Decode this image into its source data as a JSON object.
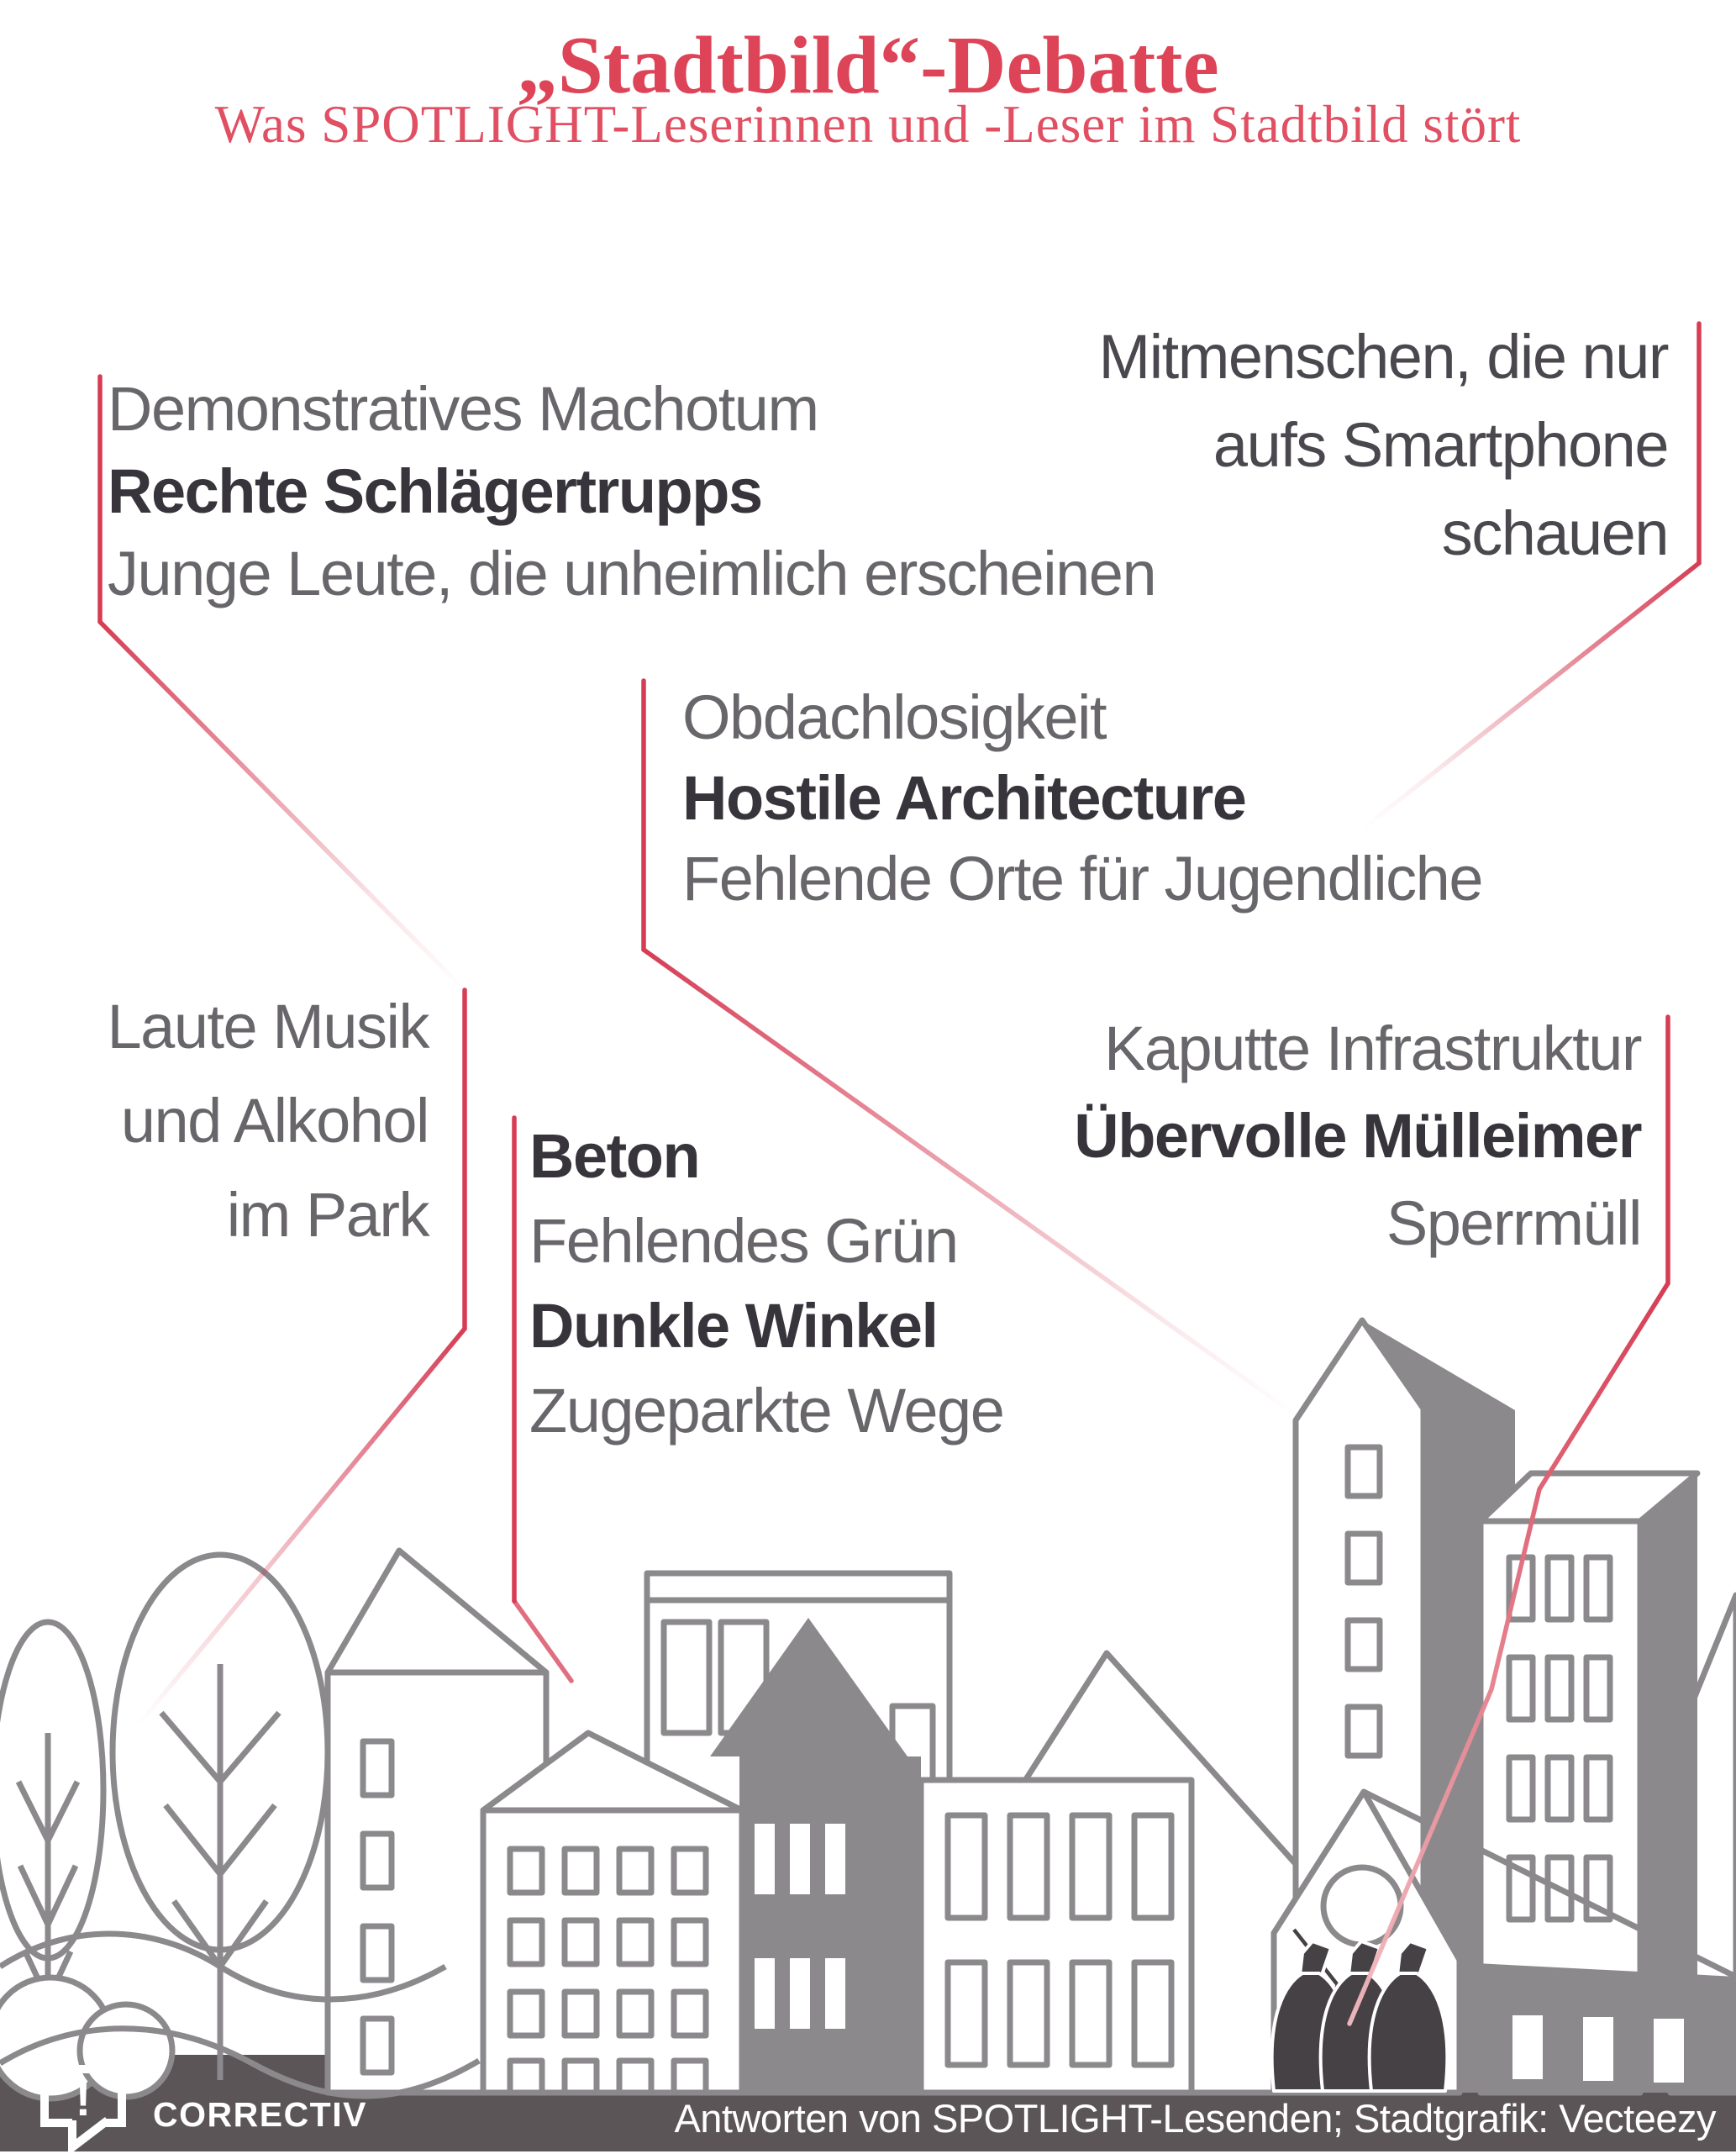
{
  "header": {
    "title": "„Stadtbild“-Debatte",
    "subtitle": "Was SPOTLIGHT-Leserinnen und -Leser im Stadtbild stört"
  },
  "clusters": [
    {
      "id": "machotum",
      "lines": [
        {
          "text": "Demonstratives Machotum",
          "emphasis": "muted"
        },
        {
          "text": "Rechte Schlägertrupps",
          "emphasis": "strong"
        },
        {
          "text": "Junge Leute, die unheimlich erscheinen",
          "emphasis": "muted"
        }
      ]
    },
    {
      "id": "smartphone",
      "lines": [
        {
          "text": "Mitmenschen, die nur",
          "emphasis": "plain"
        },
        {
          "text": "aufs Smartphone",
          "emphasis": "plain"
        },
        {
          "text": "schauen",
          "emphasis": "plain"
        }
      ]
    },
    {
      "id": "obdachlosigkeit",
      "lines": [
        {
          "text": "Obdachlosigkeit",
          "emphasis": "muted"
        },
        {
          "text": "Hostile Architecture",
          "emphasis": "strong"
        },
        {
          "text": "Fehlende Orte für Jugendliche",
          "emphasis": "muted"
        }
      ]
    },
    {
      "id": "park",
      "lines": [
        {
          "text": "Laute Musik",
          "emphasis": "muted"
        },
        {
          "text": "und Alkohol",
          "emphasis": "muted"
        },
        {
          "text": "im Park",
          "emphasis": "muted"
        }
      ]
    },
    {
      "id": "beton",
      "lines": [
        {
          "text": "Beton",
          "emphasis": "strong"
        },
        {
          "text": "Fehlendes Grün",
          "emphasis": "muted"
        },
        {
          "text": "Dunkle Winkel",
          "emphasis": "strong"
        },
        {
          "text": "Zugeparkte Wege",
          "emphasis": "muted"
        }
      ]
    },
    {
      "id": "infrastruktur",
      "lines": [
        {
          "text": "Kaputte Infrastruktur",
          "emphasis": "muted"
        },
        {
          "text": "Übervolle Mülleimer",
          "emphasis": "strong"
        },
        {
          "text": "Sperrmüll",
          "emphasis": "muted"
        }
      ]
    }
  ],
  "footer": {
    "brand": "CORRECTIV",
    "brand_mark": "!",
    "credit": "Antworten von SPOTLIGHT-Lesenden; Stadtgrafik: Vecteezy"
  },
  "colors": {
    "accent_red": "#de4457",
    "connector_red": "#d63d55",
    "connector_pale": "#f2bcc0",
    "text_muted": "#68666b",
    "text_strong": "#37353b",
    "text_plain": "#4a484e",
    "city_gray": "#8b898c",
    "footer_bg": "#5b5557",
    "bag_dark": "#454144"
  }
}
